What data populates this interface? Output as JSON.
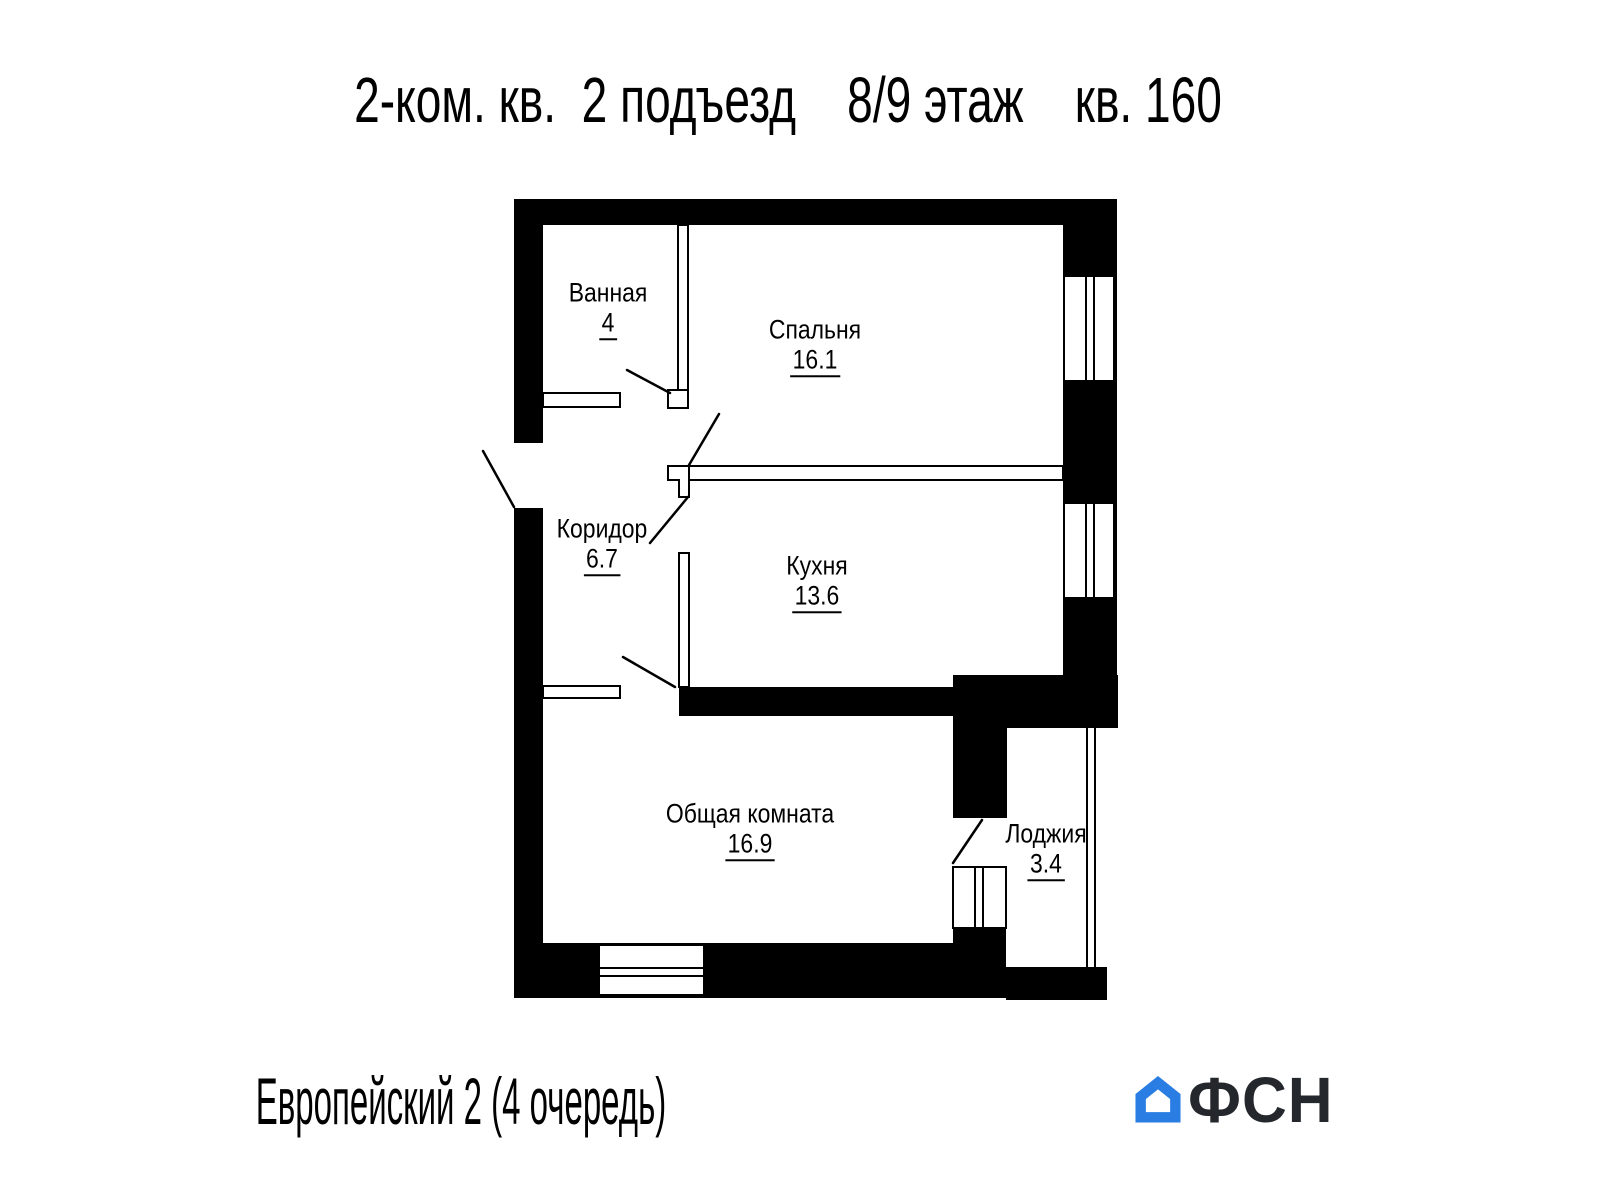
{
  "header": {
    "title": "2-ком. кв.  2 подъезд    8/9 этаж    кв. 160"
  },
  "floorplan": {
    "wall_color": "#000000",
    "rooms": [
      {
        "id": "bathroom",
        "name": "Ванная",
        "area": "4"
      },
      {
        "id": "bedroom",
        "name": "Спальня",
        "area": "16.1"
      },
      {
        "id": "corridor",
        "name": "Коридор",
        "area": "6.7"
      },
      {
        "id": "kitchen",
        "name": "Кухня",
        "area": "13.6"
      },
      {
        "id": "living-room",
        "name": "Общая комната",
        "area": "16.9"
      },
      {
        "id": "loggia",
        "name": "Лоджия",
        "area": "3.4"
      }
    ]
  },
  "footer": {
    "project": "Европейский 2 (4 очередь)",
    "logo": {
      "text": "ФСН",
      "house_color": "#2a7de2",
      "text_color": "#24272c"
    }
  }
}
